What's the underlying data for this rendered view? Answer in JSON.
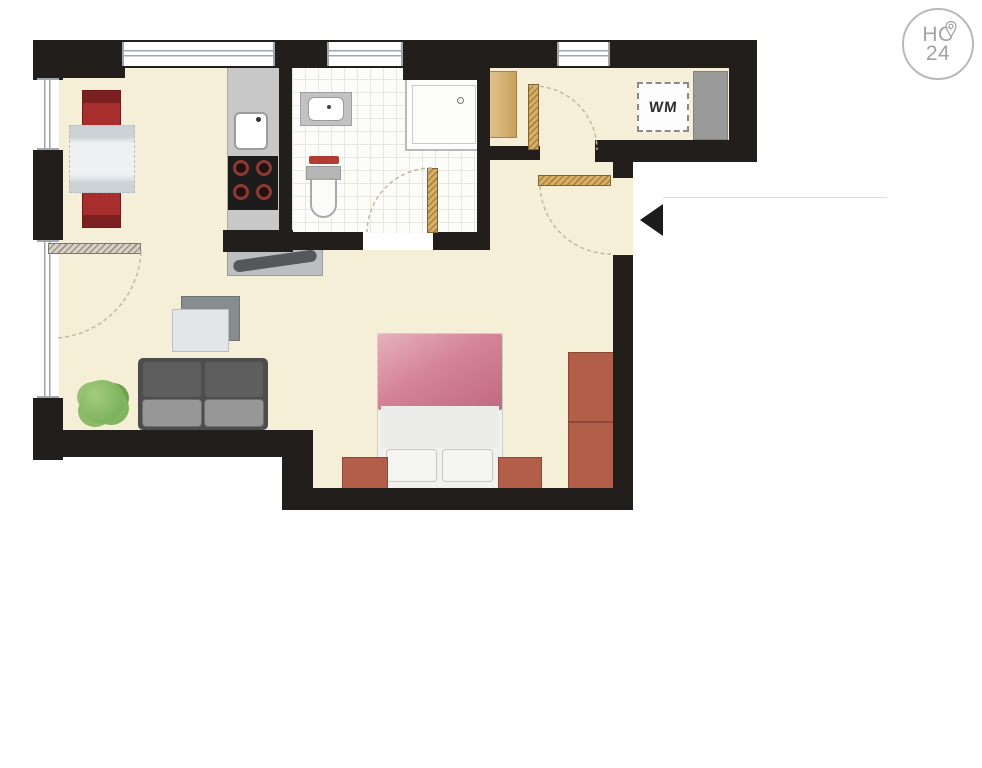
{
  "brand_badge": {
    "line1": "HC",
    "line2": "24"
  },
  "labels": {
    "washing_machine": "WM"
  },
  "icons": {
    "entrance_arrow": "left-pointing-triangle",
    "location_pin": "map-pin inside brand badge"
  },
  "colors": {
    "wall": "#211e1c",
    "floor": "#f6efd8",
    "tile": "#fcfcf9",
    "tile_grid": "#e7e7e1",
    "window_line": "#9fa6ac",
    "wood": "#d7af67",
    "terracotta": "#b25e48",
    "terracotta_dark": "#8d4936",
    "bed_pink": "#d48496",
    "chair_red": "#a82e2d",
    "chair_red_dark": "#7c1f20",
    "sofa_dark": "#4d4d4d",
    "sofa_seat": "#979797",
    "counter_gray": "#c8c8c8",
    "appliance_gray": "#9a9a9a",
    "plant_green": "#7cb25b",
    "towel_red": "#b23c35",
    "arrow_black": "#1c1c1c",
    "logo_gray": "#a3a3a3",
    "arc": "#c3b99f"
  }
}
